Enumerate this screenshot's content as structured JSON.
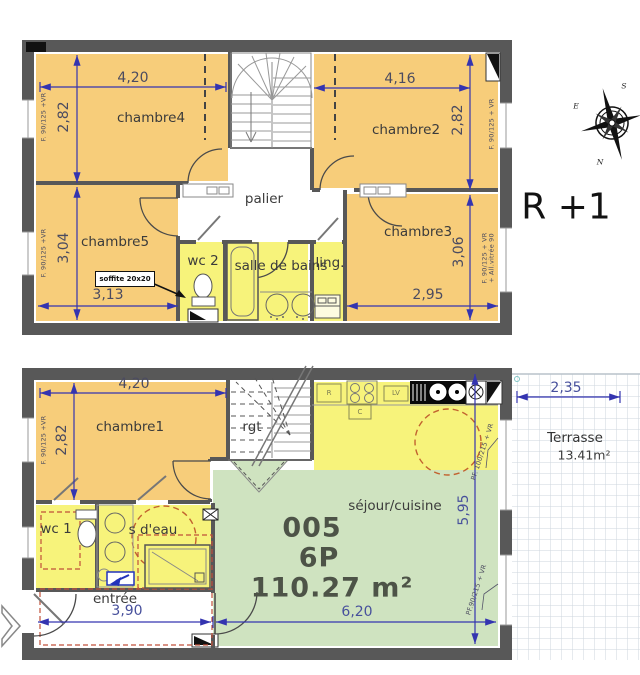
{
  "upper": {
    "title": "R +1",
    "rooms": {
      "chambre4": "chambre4",
      "chambre2": "chambre2",
      "chambre5": "chambre5",
      "chambre3": "chambre3",
      "palier": "palier",
      "wc2": "wc 2",
      "salle_de_bains": "salle de bains",
      "ling": "ling."
    },
    "dims": {
      "w_left": "4,20",
      "w_right": "4,16",
      "h_left_top": "2,82",
      "h_right_top": "2,82",
      "h_left_bottom": "3,04",
      "h_right_bottom": "3,06",
      "w_bottom_left": "3,13",
      "w_bottom_right": "2,95"
    },
    "windows": {
      "left_top": "F. 90/125 +VR",
      "left_bottom": "F. 90/125 +VR",
      "right_top": "F. 90/125 + VR",
      "right_bottom_1": "F. 90/125 + VR",
      "right_bottom_2": "+ All.vitrée 90"
    },
    "soffite": "soffite 20x20"
  },
  "lower": {
    "rooms": {
      "chambre1": "chambre1",
      "rgt": "rgt",
      "wc1": "wc 1",
      "sdeau": "s d'eau",
      "entree": "entrée",
      "sejour": "séjour/cuisine"
    },
    "unit": {
      "number": "005",
      "type": "6P",
      "area": "110.27 m²"
    },
    "terrasse": {
      "name": "Terrasse",
      "area": "13.41m²",
      "width_dim": "2,35"
    },
    "dims": {
      "top": "4,20",
      "left": "2,82",
      "entree_width": "3,90",
      "sejour_width": "6,20",
      "sejour_height": "5,95"
    },
    "windows": {
      "left": "F. 90/125 +VR",
      "right_top": "PF. 100/215 + VR",
      "right_bottom": "PF.90/215 + VR"
    },
    "appliances": {
      "fridge": "R",
      "hob": "C",
      "dishwasher": "LV"
    }
  },
  "compass": {
    "s": "S",
    "e": "E",
    "n": "N"
  }
}
